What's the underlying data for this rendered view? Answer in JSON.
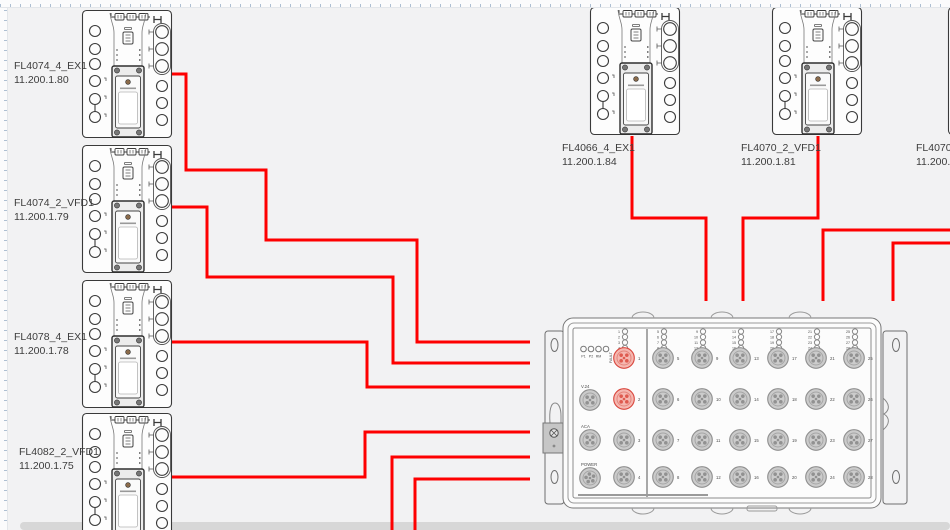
{
  "app": {
    "background_color": "#f2f2f3",
    "cable_color": "#fe0000",
    "outline_color": "#3a3a3a",
    "port_highlight_fill": "#f5b7b0",
    "port_highlight_stroke": "#d9453c"
  },
  "devices": [
    {
      "name": "FL4074_4_EX1",
      "ip": "11.200.1.80",
      "x": 82,
      "y": 10,
      "label_x": 14,
      "label_y": 59
    },
    {
      "name": "FL4074_2_VFD1",
      "ip": "11.200.1.79",
      "x": 82,
      "y": 145,
      "label_x": 14,
      "label_y": 196
    },
    {
      "name": "FL4078_4_EX1",
      "ip": "11.200.1.78",
      "x": 82,
      "y": 280,
      "label_x": 14,
      "label_y": 330
    },
    {
      "name": "FL4082_2_VFD1",
      "ip": "11.200.1.75",
      "x": 82,
      "y": 413,
      "label_x": 19,
      "label_y": 445
    },
    {
      "name": "FL4066_4_EX1",
      "ip": "11.200.1.84",
      "x": 590,
      "y": 7,
      "label_x": 562,
      "label_y": 141
    },
    {
      "name": "FL4070_2_VFD1",
      "ip": "11.200.1.81",
      "x": 772,
      "y": 7,
      "label_x": 741,
      "label_y": 141
    },
    {
      "name": "FL4070_",
      "ip": "11.200.1",
      "x": 948,
      "y": 7,
      "label_x": 916,
      "label_y": 141
    }
  ],
  "cables": [
    {
      "points": [
        [
          172,
          74
        ],
        [
          186,
          74
        ],
        [
          186,
          170
        ],
        [
          266,
          170
        ],
        [
          266,
          240
        ],
        [
          417,
          240
        ],
        [
          417,
          342
        ],
        [
          530,
          342
        ]
      ]
    },
    {
      "points": [
        [
          172,
          207
        ],
        [
          207,
          207
        ],
        [
          207,
          277
        ],
        [
          393,
          277
        ],
        [
          393,
          363
        ],
        [
          530,
          363
        ]
      ]
    },
    {
      "points": [
        [
          172,
          342
        ],
        [
          367,
          342
        ],
        [
          367,
          387
        ],
        [
          530,
          387
        ]
      ]
    },
    {
      "points": [
        [
          172,
          477
        ],
        [
          365,
          477
        ],
        [
          365,
          432
        ],
        [
          530,
          432
        ]
      ]
    },
    {
      "points": [
        [
          392,
          531
        ],
        [
          392,
          457
        ],
        [
          530,
          457
        ]
      ]
    },
    {
      "points": [
        [
          415,
          531
        ],
        [
          415,
          479
        ],
        [
          530,
          479
        ]
      ]
    },
    {
      "points": [
        [
          632,
          136
        ],
        [
          632,
          218
        ],
        [
          706,
          218
        ],
        [
          706,
          301
        ]
      ]
    },
    {
      "points": [
        [
          818,
          136
        ],
        [
          818,
          218
        ],
        [
          743,
          218
        ],
        [
          743,
          301
        ]
      ]
    },
    {
      "points": [
        [
          952,
          230
        ],
        [
          823,
          230
        ],
        [
          823,
          301
        ]
      ]
    },
    {
      "points": [
        [
          952,
          243
        ],
        [
          893,
          243
        ],
        [
          893,
          301
        ]
      ]
    }
  ],
  "switch": {
    "status_leds": [
      "P1",
      "P2",
      "RM"
    ],
    "fault_label": "FAULT",
    "aux_ports": [
      "V.24",
      "ACA",
      "POWER"
    ],
    "columns": [
      {
        "leds": [
          1,
          2,
          3,
          4
        ],
        "ports": [
          1,
          2,
          3,
          4
        ]
      },
      {
        "leds": [
          5,
          6,
          7,
          8
        ],
        "ports": [
          5,
          6,
          7,
          8
        ]
      },
      {
        "leds": [
          9,
          10,
          11,
          12
        ],
        "ports": [
          9,
          10,
          11,
          12
        ]
      },
      {
        "leds": [
          13,
          14,
          15,
          16
        ],
        "ports": [
          13,
          14,
          15,
          16
        ]
      },
      {
        "leds": [
          17,
          18,
          19,
          20
        ],
        "ports": [
          17,
          18,
          19,
          20
        ]
      },
      {
        "leds": [
          21,
          22,
          23,
          24
        ],
        "ports": [
          21,
          22,
          23,
          24
        ]
      },
      {
        "leds": [
          25,
          26,
          27,
          28
        ],
        "ports": [
          25,
          26,
          27,
          28
        ]
      }
    ],
    "highlighted_ports": [
      1,
      2
    ]
  }
}
